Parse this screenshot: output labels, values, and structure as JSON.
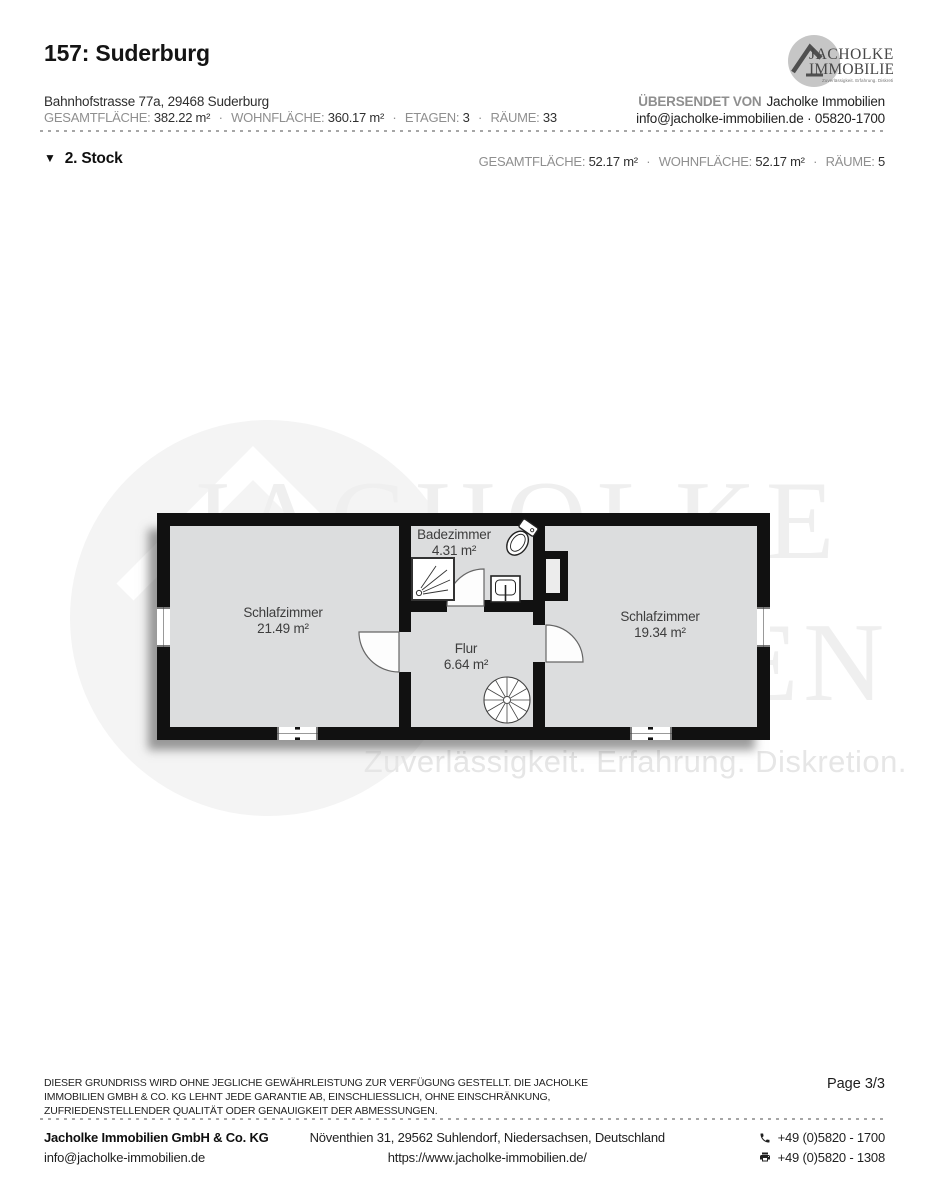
{
  "sep": "·",
  "header": {
    "title": "157: Suderburg",
    "address": "Bahnhofstrasse 77a, 29468 Suderburg",
    "stats": [
      {
        "label": "GESAMTFLÄCHE:",
        "value": "382.22 m²"
      },
      {
        "label": "WOHNFLÄCHE:",
        "value": "360.17 m²"
      },
      {
        "label": "ETAGEN:",
        "value": "3"
      },
      {
        "label": "RÄUME:",
        "value": "33"
      }
    ],
    "sent_by_label": "ÜBERSENDET VON",
    "sent_by": "Jacholke Immobilien",
    "contact_line": "info@jacholke-immobilien.de · 05820-1700"
  },
  "logo": {
    "word1": "JACHOLKE",
    "word2": "IMMOBILIEN",
    "tagline": "Zuverlässigkeit. Erfahrung. Diskretion."
  },
  "section": {
    "triangle_icon": "▼",
    "title": "2. Stock",
    "stats": [
      {
        "label": "GESAMTFLÄCHE:",
        "value": "52.17 m²"
      },
      {
        "label": "WOHNFLÄCHE:",
        "value": "52.17 m²"
      },
      {
        "label": "RÄUME:",
        "value": "5"
      }
    ]
  },
  "floorplan": {
    "rooms": [
      {
        "name": "Schlafzimmer",
        "area": "21.49 m²"
      },
      {
        "name": "Badezimmer",
        "area": "4.31 m²"
      },
      {
        "name": "Flur",
        "area": "6.64 m²"
      },
      {
        "name": "Schlafzimmer",
        "area": "19.34 m²"
      }
    ]
  },
  "watermark": {
    "word1": "JACHOLKE",
    "word2": "IMMOBILIEN",
    "tagline": "Zuverlässigkeit. Erfahrung. Diskretion."
  },
  "disclaimer": "DIESER GRUNDRISS WIRD OHNE JEGLICHE GEWÄHRLEISTUNG ZUR VERFÜGUNG GESTELLT. DIE JACHOLKE IMMOBILIEN GMBH & CO. KG LEHNT JEDE GARANTIE AB, EINSCHLIESSLICH, OHNE EINSCHRÄNKUNG, ZUFRIEDENSTELLENDER QUALITÄT ODER GENAUIGKEIT DER ABMESSUNGEN.",
  "page_label": "Page 3/3",
  "footer": {
    "company": "Jacholke Immobilien GmbH & Co. KG",
    "email": "info@jacholke-immobilien.de",
    "address": "Növenthien 31, 29562 Suhlendorf, Niedersachsen, Deutschland",
    "website": "https://www.jacholke-immobilien.de/",
    "phone": "+49 (0)5820 - 1700",
    "fax": "+49 (0)5820 - 1308"
  },
  "colors": {
    "wall": "#111111",
    "room_fill": "#edeeee",
    "watermark": "#efefef",
    "logo_circle": "#c6c6c6",
    "label_gray": "#8f8f8f"
  }
}
